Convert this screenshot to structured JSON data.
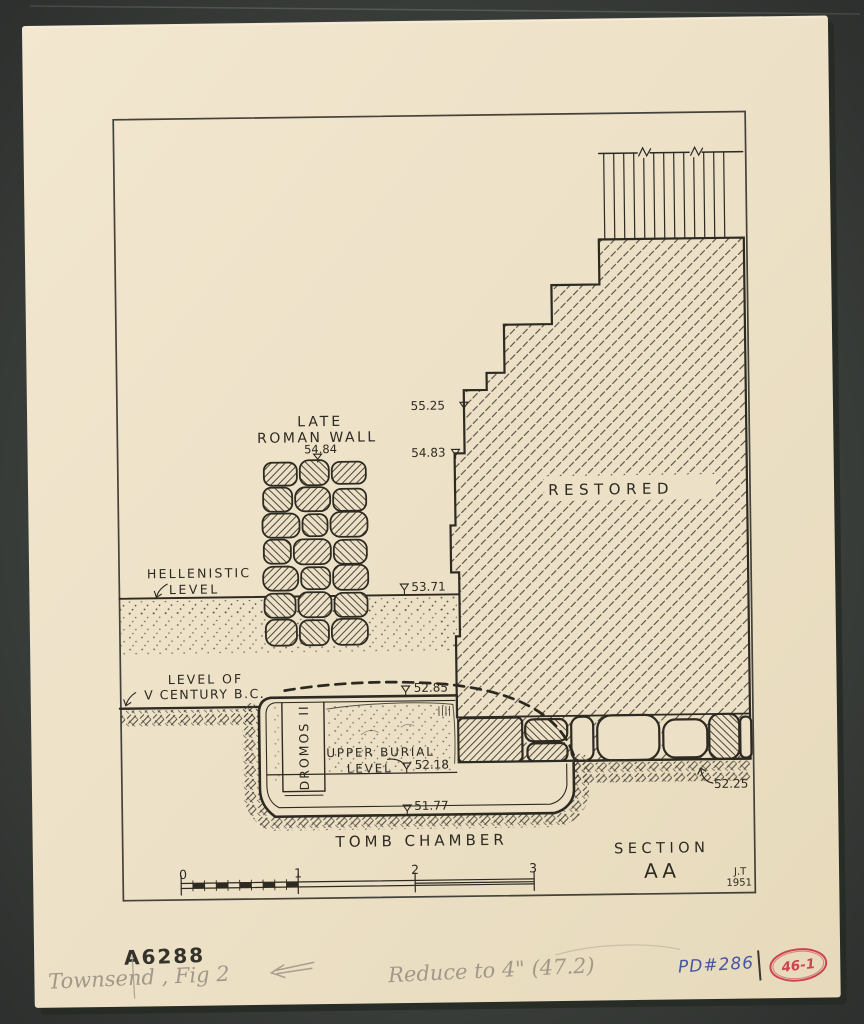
{
  "colors": {
    "background": "#3a3e3b",
    "paper": "#ece0c6",
    "ink": "#2d2a22",
    "pencil": "#a2988a",
    "blue_ink": "#4456a2",
    "red_ink": "#cf4350"
  },
  "drawing": {
    "wall_label_line1": "LATE",
    "wall_label_line2": "ROMAN WALL",
    "wall_elevation": "54.84",
    "elevations": {
      "top": "55.25",
      "second": "54.83",
      "hellenistic": "53.71",
      "fifth_century": "52.85",
      "upper_burial": "52.18",
      "floor": "51.77",
      "foundation": "52.25"
    },
    "hellenistic_label_line1": "HELLENISTIC",
    "hellenistic_label_line2": "LEVEL",
    "fifth_century_label_line1": "LEVEL OF",
    "fifth_century_label_line2": "V CENTURY B.C.",
    "dromos_label": "DROMOS II",
    "upper_burial_label_line1": "UPPER BURIAL",
    "upper_burial_label_line2": "LEVEL",
    "tomb_chamber_label": "TOMB CHAMBER",
    "restored_label": "RESTORED",
    "section_label": "SECTION",
    "section_name": "AA",
    "author_initials": "J.T",
    "year": "1951",
    "scale": {
      "t0": "0",
      "t1": "1",
      "t2": "2",
      "t3": "3"
    }
  },
  "annotations": {
    "catalog_number": "A6288",
    "pencil_note": "Townsend , Fig 2",
    "pencil_instruction": "Reduce to 4\" (47.2)",
    "pd_number": "PD#286",
    "plate_number": "46-1"
  }
}
